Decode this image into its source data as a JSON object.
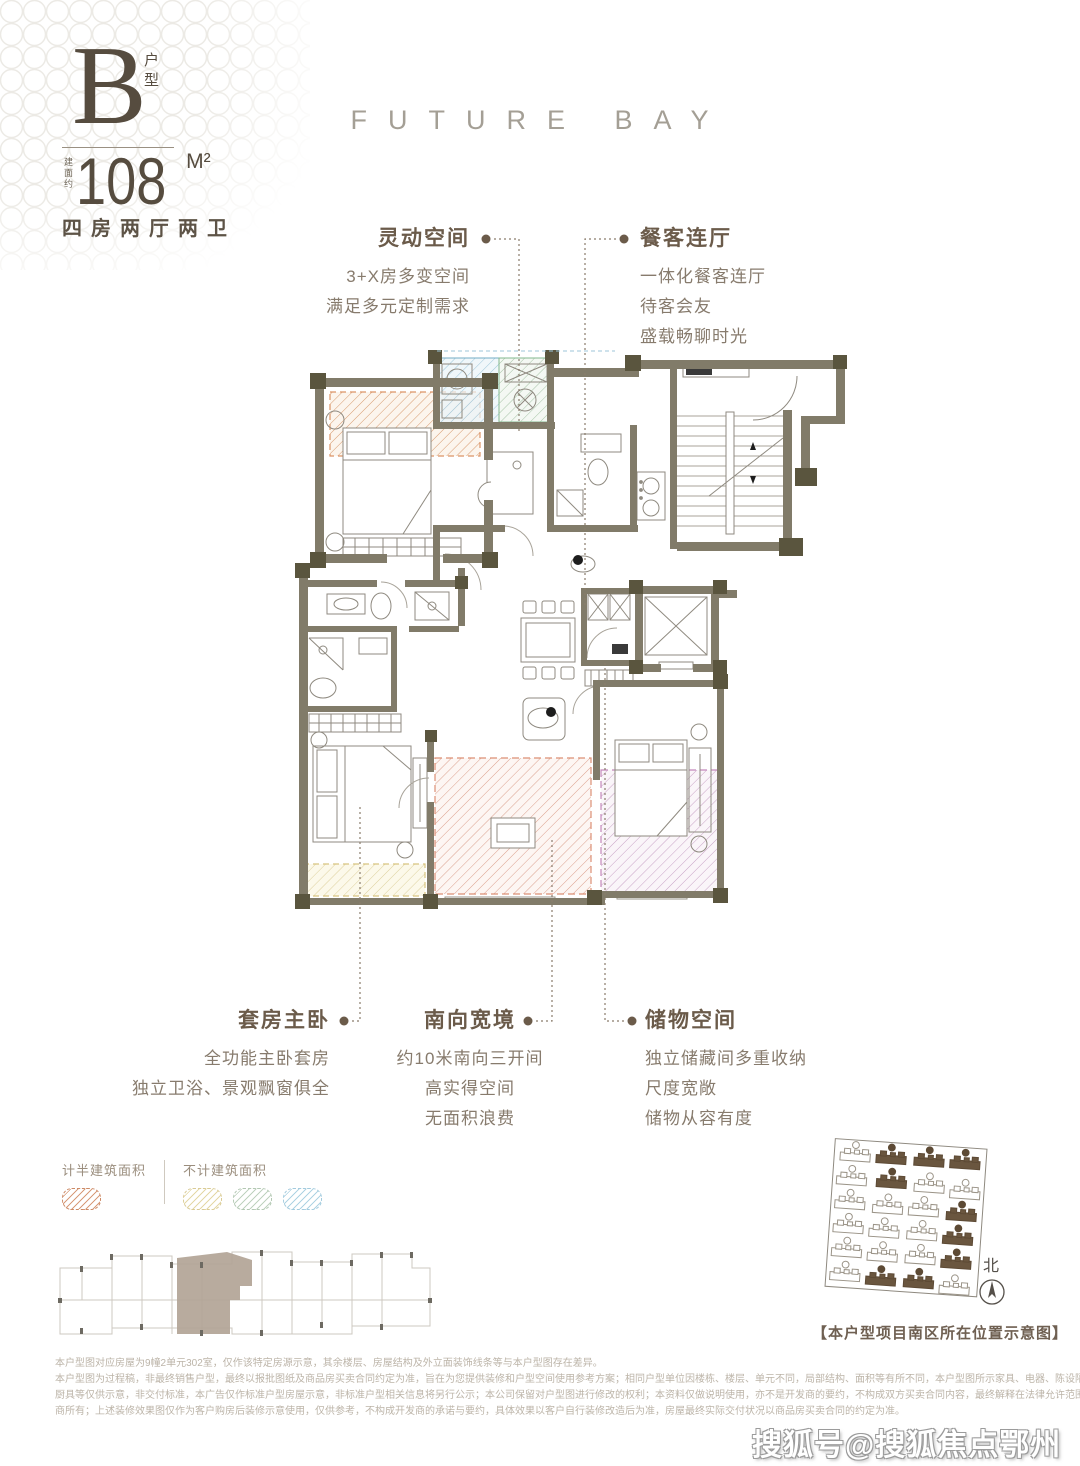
{
  "unit": {
    "type_letter": "B",
    "type_suffix": "户型",
    "area_prefix": "建面约",
    "area_value": "108",
    "area_unit": "M²",
    "layout": "四房两厅两卫"
  },
  "brand": "FUTURE BAY",
  "features": [
    {
      "title": "灵动空间",
      "lines": [
        "3+X房多变空间",
        "满足多元定制需求"
      ]
    },
    {
      "title": "餐客连厅",
      "lines": [
        "一体化餐客连厅",
        "待客会友",
        "盛载畅聊时光"
      ]
    },
    {
      "title": "套房主卧",
      "lines": [
        "全功能主卧套房",
        "独立卫浴、景观飘窗俱全"
      ]
    },
    {
      "title": "南向宽境",
      "lines": [
        "约10米南向三开间",
        "高实得空间",
        "无面积浪费"
      ]
    },
    {
      "title": "储物空间",
      "lines": [
        "独立储藏间多重收纳",
        "尺度宽敞",
        "储物从容有度"
      ]
    }
  ],
  "legend": {
    "half_area_label": "计半建筑面积",
    "excluded_label": "不计建筑面积",
    "colors": {
      "half": "#cc8a66",
      "yellow": "#e4d8a6",
      "green": "#bfd2bf",
      "blue": "#aed3e3"
    }
  },
  "plan_zone_colors": {
    "bay_half_area": "#dc9466",
    "south_terrace": "#dc8f75",
    "bedroom_overlay": "#c488bc",
    "utility_blue": "#74aec6",
    "utility_green": "#83b98f",
    "bay_yellow": "#d8c480",
    "wall": "#817b69",
    "wall_block": "#5a553e"
  },
  "site_plan": {
    "caption": "【本户型项目南区所在位置示意图】",
    "north_label": "北"
  },
  "disclaimer": {
    "lines": [
      "本户型图对应房屋为9幢2单元302室，仅作该特定房源示意，其余楼层、房屋结构及外立面装饰线条等与本户型图存在差异。",
      "本户型图为过程稿，非最终销售户型，最终以报批图纸及商品房买卖合同约定为准，旨在为您提供装修和户型空间使用参考方案；相同户型单位因楼栋、楼层、单元不同，局部结构、面积等有所不同，本户型图所示家具、电器、陈设隔断、洁具、",
      "厨具等仅供示意，非交付标准，本广告仅作标准户型房屋示意，非标准户型相关信息将另行公示；本公司保留对户型图进行修改的权利；本资料仅做说明使用，亦不是开发商的要约，不构成双方买卖合同内容，最终解释在法律允许范围内归开发",
      "商所有；上述装修效果图仅作为客户购房后装修示意使用，仅供参考，不构成开发商的承诺与要约，具体效果以客户自行装修改造后为准，房屋最终实际交付状况以商品房买卖合同的约定为准。"
    ]
  },
  "watermark": "搜狐号@搜狐焦点鄂州站"
}
